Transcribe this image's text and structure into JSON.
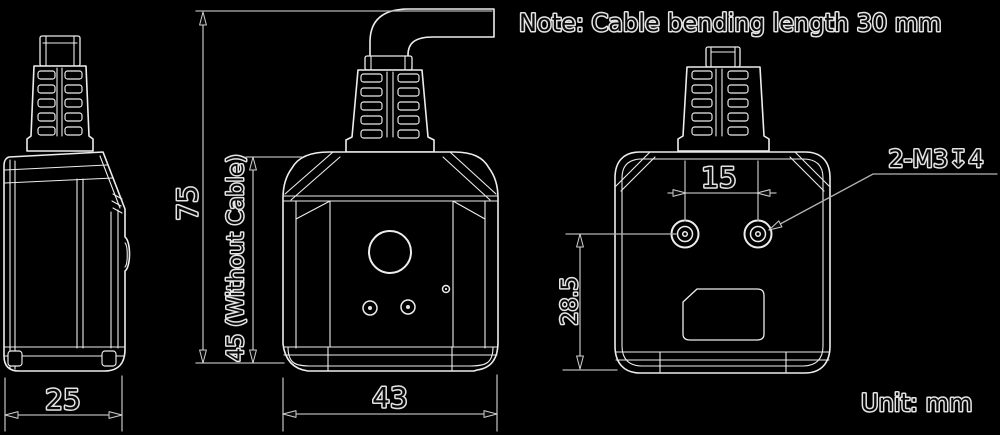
{
  "note": "Note: Cable bending length 30 mm",
  "unit": "Unit: mm",
  "dimensions": {
    "side_width": "25",
    "front_width": "43",
    "overall_height_with_cable": "75",
    "height_without_cable": "45 (Without Cable)",
    "mounting_hole_spacing": "15",
    "mounting_hole_height": "28.5",
    "thread_callout": "2-M3↧4"
  },
  "colors": {
    "background": "#000000",
    "linework": "#ededed",
    "dimension_lines": "#b5b5b5",
    "text_fill": "#0a0a0a",
    "text_halo": "#e4e4e4"
  }
}
